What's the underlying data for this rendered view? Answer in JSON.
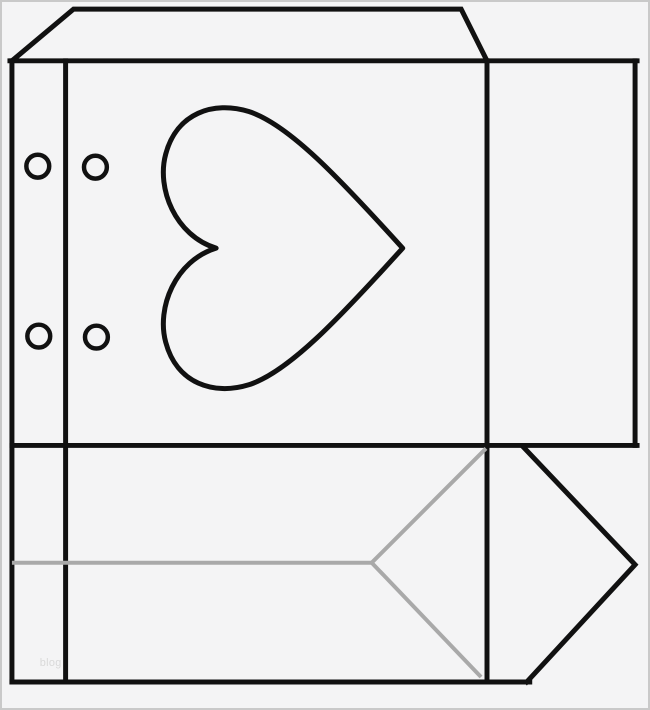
{
  "watermark": {
    "text": "blog"
  },
  "colors": {
    "background": "#f4f4f5",
    "frame": "#c9c9c9",
    "cut": "#111111",
    "fold": "#a9a9a9",
    "watermark": "#d9d9d9"
  },
  "shapes": {
    "heart_icon": "heart-cutout",
    "punch_hole_count": 4
  }
}
